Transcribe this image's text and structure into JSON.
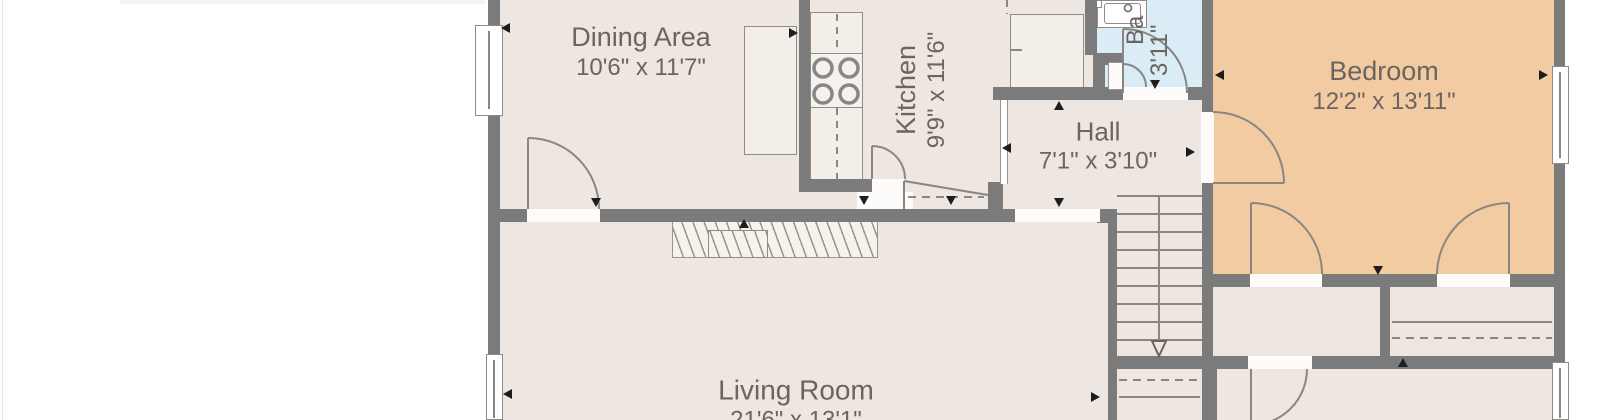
{
  "plan": {
    "rooms": {
      "dining": {
        "name": "Dining Area",
        "dims": "10'6\" x 11'7\""
      },
      "kitchen": {
        "name": "Kitchen",
        "dims": "9'9\" x 11'6\""
      },
      "hall": {
        "name": "Hall",
        "dims": "7'1\" x 3'10\""
      },
      "bedroom": {
        "name": "Bedroom",
        "dims": "12'2\" x 13'11\""
      },
      "living": {
        "name": "Living Room",
        "dims": "21'6\" x 13'1\""
      },
      "bathroom": {
        "name_partial": "Ba",
        "dims_partial": "3'11\""
      }
    },
    "stairs": {
      "down_arrow": "▽"
    },
    "colors": {
      "wall": "#7b7b7b",
      "floor": "#ede6e1",
      "bedroom_floor": "#f2cba3",
      "bathroom_floor": "#daedf6",
      "counter": "#f4eee9",
      "label_text": "#6b6560",
      "linework": "#8a8683",
      "marker": "#1d1d1d"
    }
  }
}
